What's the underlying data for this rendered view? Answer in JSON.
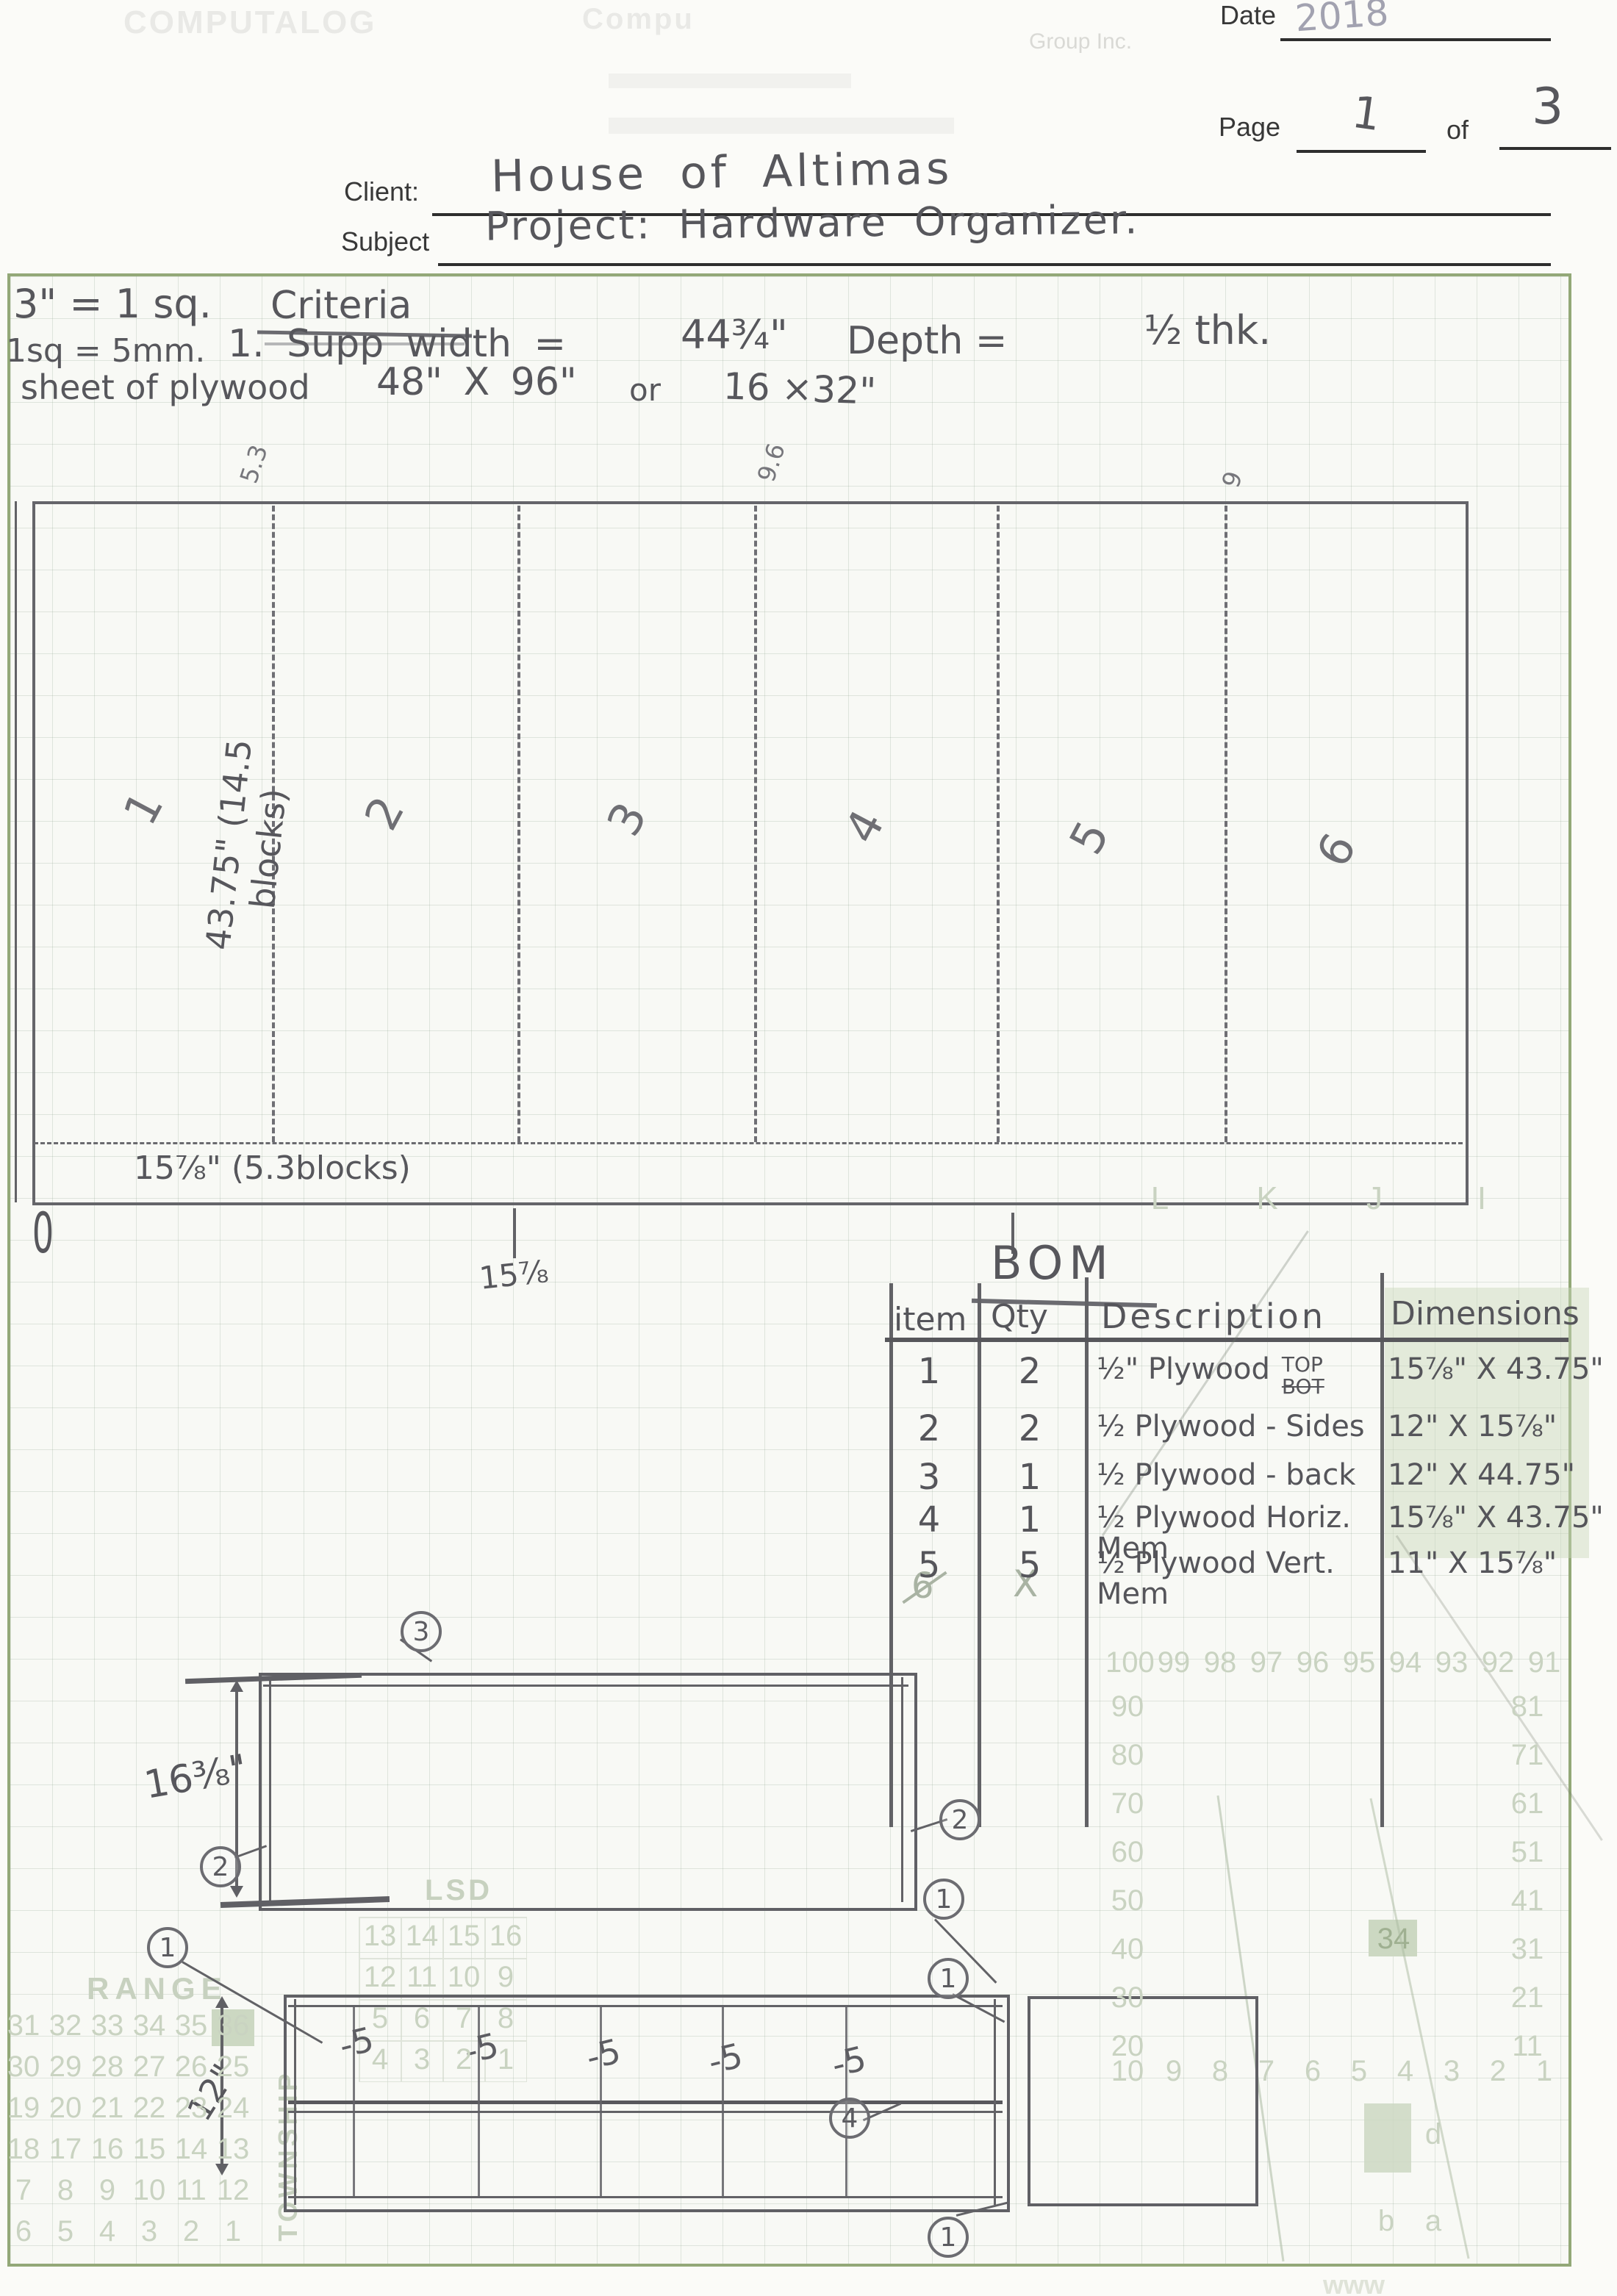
{
  "letterhead": {
    "logo": "COMPUTALOG",
    "brand_fragment": "Compu",
    "group": "Group Inc."
  },
  "header": {
    "date_label": "Date",
    "date_value": "2018",
    "page_label": "Page",
    "page_number": "1",
    "of_label": "of",
    "total_pages": "3",
    "client_label": "Client:",
    "client_value": "House of  Altimas",
    "subject_label": "Subject",
    "subject_value": "Project:  Hardware  Organizer."
  },
  "notes": {
    "scale_note_1": "3\" = 1 sq.",
    "criteria_title": "Criteria",
    "scale_note_2": "1sq = 5mm.",
    "supp_width": "1. Supp   width =",
    "supp_width_value": "44¾\"",
    "depth_label": "Depth =",
    "depth_value": "½ thk.",
    "sheet_label": "sheet of plywood",
    "sheet_dims": "48\" X 96\"",
    "or_label": "or",
    "alt_dims": "16  ×32\""
  },
  "cut_layout": {
    "side_label": "43.75\" (14.5 blocks)",
    "top_labels": [
      "5.3",
      "9.6",
      "9"
    ],
    "section_numbers": [
      "1",
      "2",
      "3",
      "4",
      "5",
      "6"
    ],
    "strip_label": "15⅞\" (5.3blocks)",
    "origin_label": "0",
    "tick_label": "15⅞"
  },
  "bom": {
    "title": "BOM",
    "columns": [
      "item",
      "Qty",
      "Description",
      "Dimensions"
    ],
    "rows": [
      {
        "item": "1",
        "qty": "2",
        "desc": "½\" Plywood",
        "note_top": "TOP",
        "note_bot": "BOT",
        "dims": "15⅞\" X 43.75\""
      },
      {
        "item": "2",
        "qty": "2",
        "desc": "½ Plywood - Sides",
        "dims": "12\"  X 15⅞\""
      },
      {
        "item": "3",
        "qty": "1",
        "desc": "½ Plywood - back",
        "dims": "12\"  X 44.75\""
      },
      {
        "item": "4",
        "qty": "1",
        "desc": "½ Plywood  Horiz. Mem",
        "dims": "15⅞\"  X 43.75\""
      },
      {
        "item": "5",
        "qty": "5",
        "desc": "½ Plywood  Vert. Mem",
        "dims": "11\"  X 15⅞\""
      }
    ],
    "crossed_item": "6",
    "crossed_qty": "X"
  },
  "drawings": {
    "top_view_dim": "16⅜\"",
    "front_view_dim": "12\"",
    "divider_labels": [
      "-5",
      "-5",
      "-5",
      "-5",
      "-5"
    ],
    "callout_values": [
      "3",
      "2",
      "2",
      "1",
      "1",
      "1",
      "4",
      "1"
    ]
  },
  "preprinted": {
    "lsd_title": "LSD",
    "lsd_rows": [
      [
        "13",
        "14",
        "15",
        "16"
      ],
      [
        "12",
        "11",
        "10",
        "9"
      ],
      [
        "5",
        "6",
        "7",
        "8"
      ],
      [
        "4",
        "3",
        "2",
        "1"
      ]
    ],
    "range_title": "RANGE",
    "range_rows": [
      [
        "31",
        "32",
        "33",
        "34",
        "35",
        "36"
      ],
      [
        "30",
        "29",
        "28",
        "27",
        "26",
        "25"
      ],
      [
        "19",
        "20",
        "21",
        "22",
        "23",
        "24"
      ],
      [
        "18",
        "17",
        "16",
        "15",
        "14",
        "13"
      ],
      [
        "7",
        "8",
        "9",
        "10",
        "11",
        "12"
      ],
      [
        "6",
        "5",
        "4",
        "3",
        "2",
        "1"
      ]
    ],
    "township": "TOWNSHIP",
    "letters": [
      "L",
      "K",
      "J",
      "I"
    ],
    "top_row": [
      "100",
      "99",
      "98",
      "97",
      "96",
      "95",
      "94",
      "93",
      "92",
      "91"
    ],
    "left_col": [
      "90",
      "80",
      "70",
      "60",
      "50",
      "40",
      "30",
      "20"
    ],
    "right_col": [
      "81",
      "71",
      "61",
      "51",
      "41",
      "31",
      "21",
      "11"
    ],
    "bottom_row": [
      "10",
      "9",
      "8",
      "7",
      "6",
      "5",
      "4",
      "3",
      "2",
      "1"
    ],
    "highlight_34": "34",
    "corner_letters": {
      "d": "d",
      "b": "b",
      "a": "a"
    },
    "www": "www"
  }
}
